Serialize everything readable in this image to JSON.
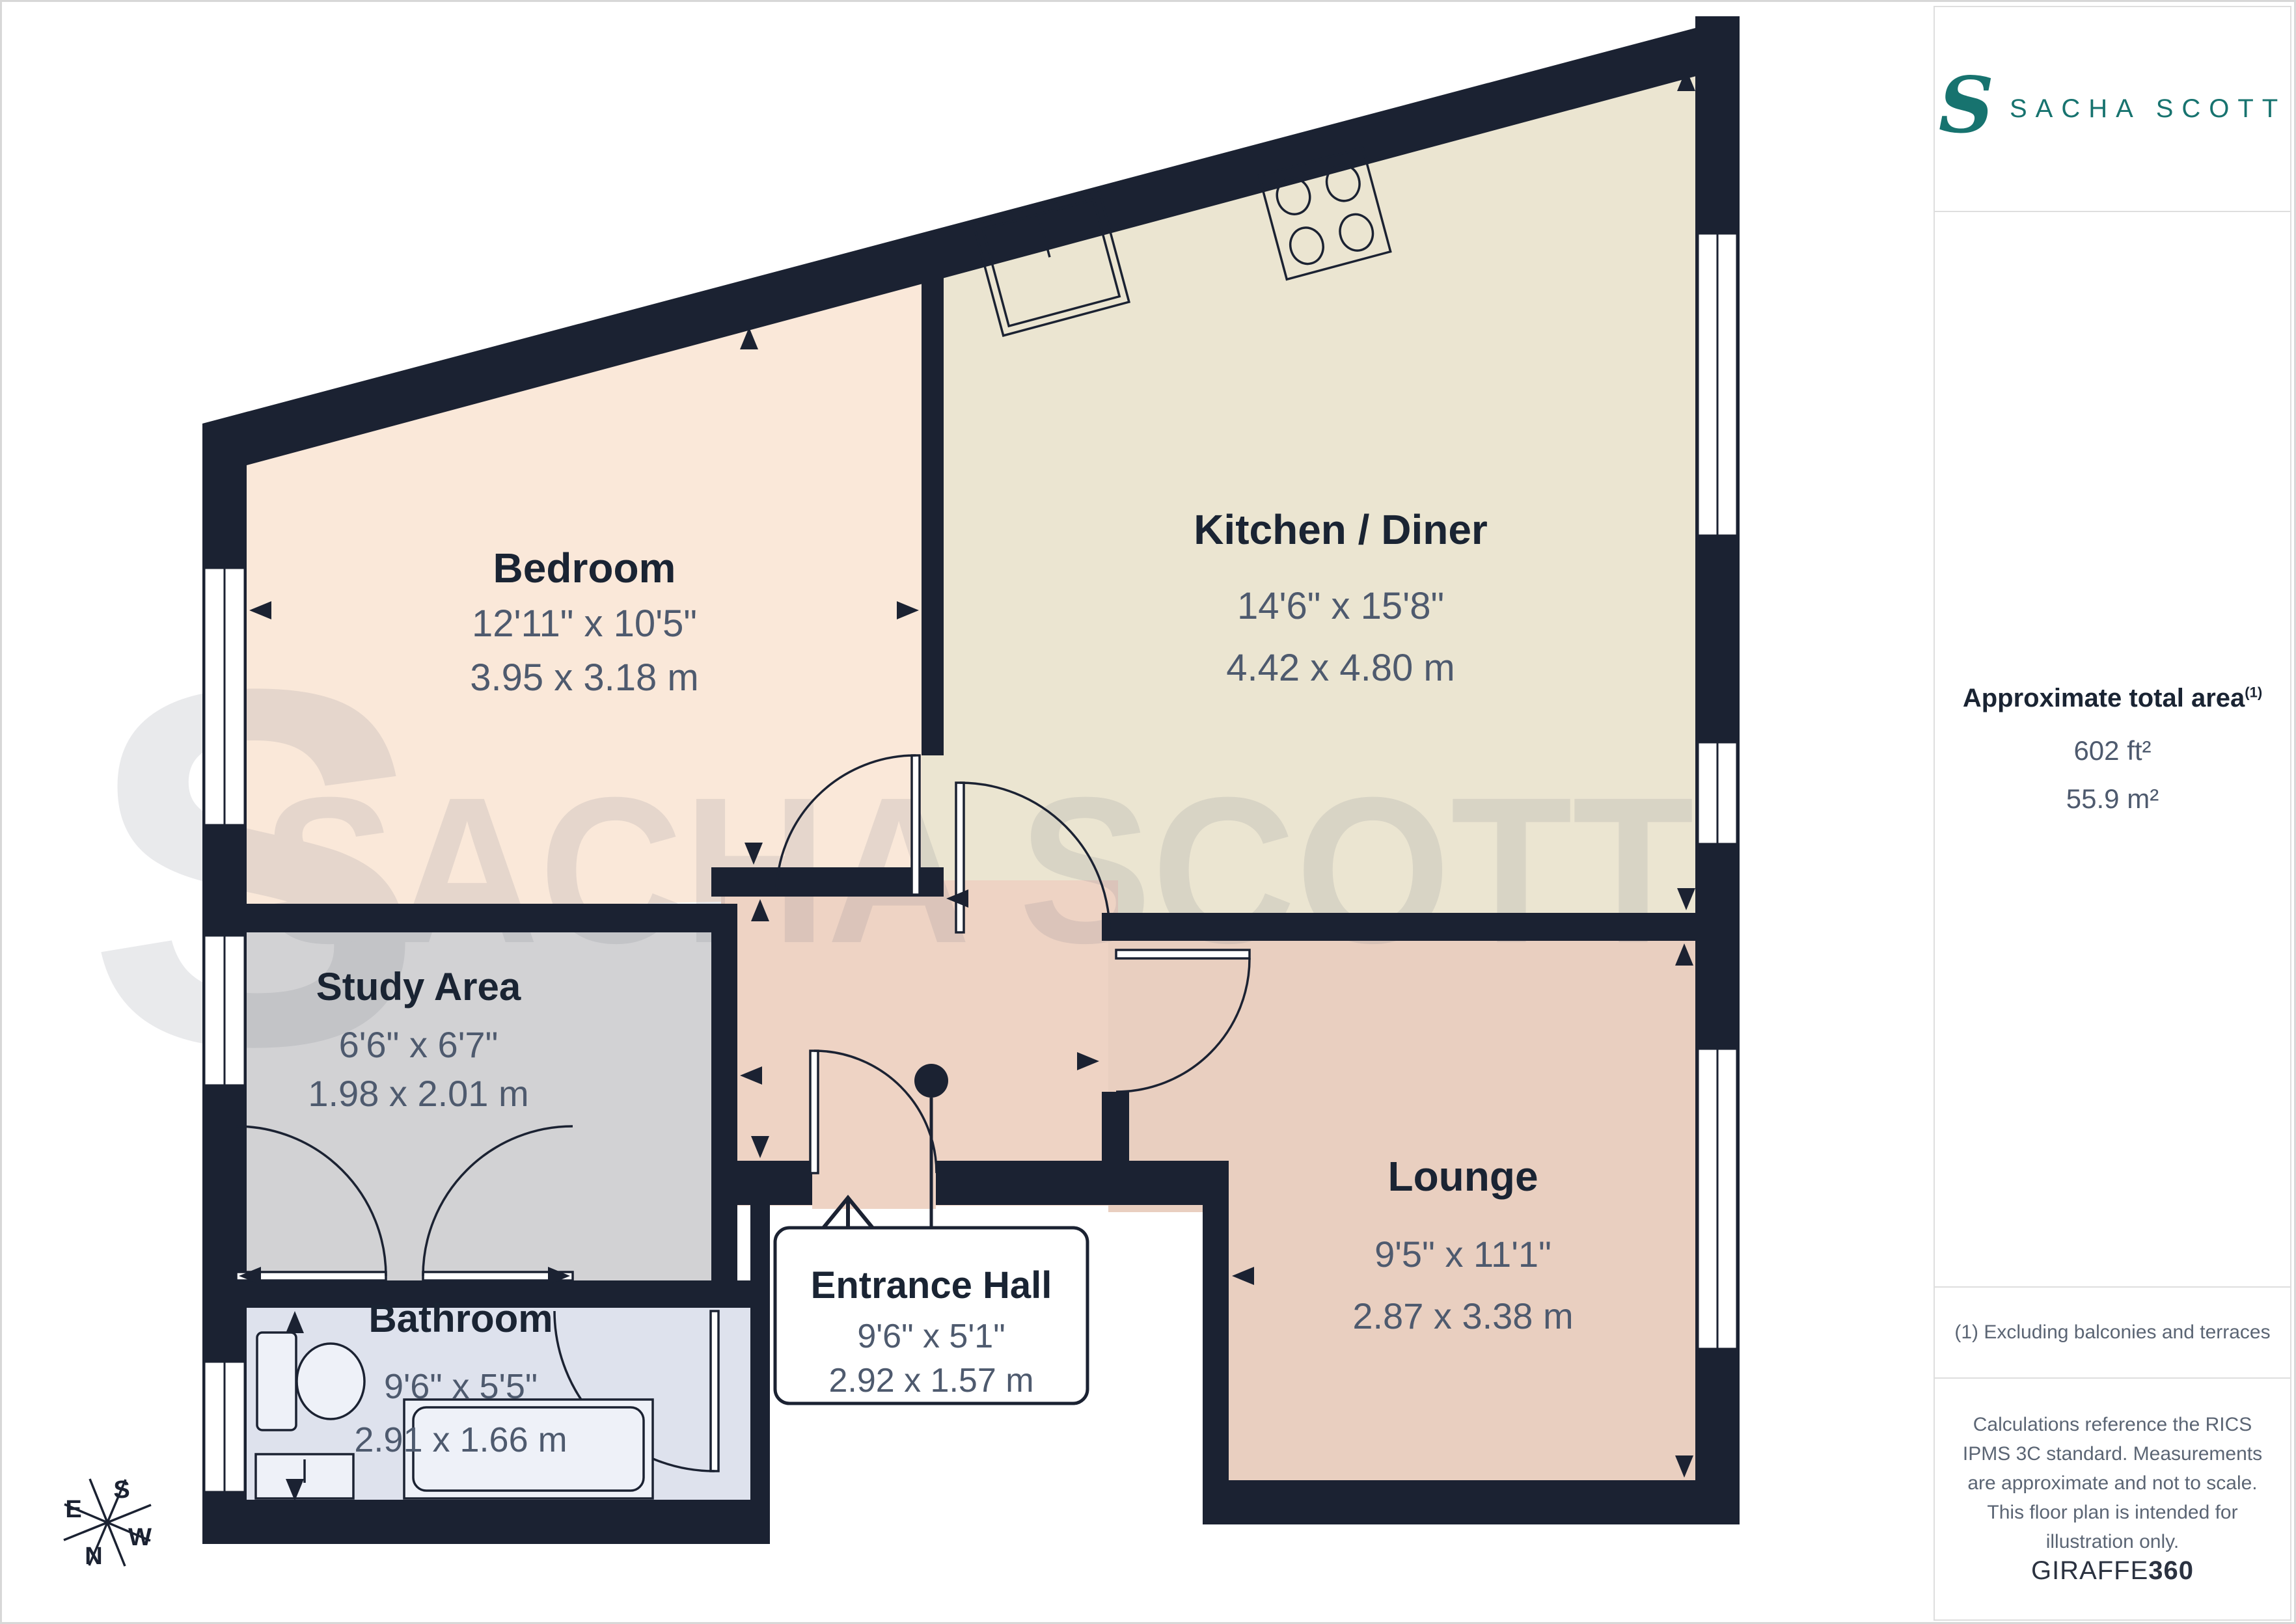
{
  "plan": {
    "rooms": {
      "bedroom": {
        "name": "Bedroom",
        "dims_imperial": "12'11\" x 10'5\"",
        "dims_metric": "3.95 x 3.18 m"
      },
      "kitchen": {
        "name": "Kitchen / Diner",
        "dims_imperial": "14'6\" x 15'8\"",
        "dims_metric": "4.42 x 4.80 m"
      },
      "study": {
        "name": "Study Area",
        "dims_imperial": "6'6\" x 6'7\"",
        "dims_metric": "1.98 x 2.01 m"
      },
      "lounge": {
        "name": "Lounge",
        "dims_imperial": "9'5\" x 11'1\"",
        "dims_metric": "2.87 x 3.38 m"
      },
      "entrance_hall": {
        "name": "Entrance Hall",
        "dims_imperial": "9'6\" x 5'1\"",
        "dims_metric": "2.92 x 1.57 m"
      },
      "bathroom": {
        "name": "Bathroom",
        "dims_imperial": "9'6\" x 5'5\"",
        "dims_metric": "2.91 x 1.66 m"
      }
    },
    "watermark": {
      "initial": "S",
      "text": "SACHA SCOTT"
    },
    "compass": {
      "n": "N",
      "e": "E",
      "s": "S",
      "w": "W"
    }
  },
  "sidebar": {
    "logo": {
      "initial": "S",
      "brand": "SACHA SCOTT",
      "color": "#17736f"
    },
    "area": {
      "title": "Approximate total area",
      "marker": "(1)",
      "imperial": "602 ft²",
      "metric": "55.9 m²"
    },
    "footnote": "(1) Excluding balconies and terraces",
    "disclaimer": "Calculations reference the RICS IPMS 3C standard. Measurements are approximate and not to scale. This floor plan is intended for illustration only.",
    "credit": {
      "brand": "GIRAFFE",
      "suffix": "360"
    }
  },
  "colors": {
    "wall": "#1b2232",
    "bedroom": "#fae8d9",
    "kitchen": "#ebe5d1",
    "study": "#d2d2d4",
    "hall": "#eed3c4",
    "lounge": "#e9cfc0",
    "bathroom": "#dee2ed",
    "brand_teal": "#17736f",
    "dims_text": "#4e5a6e"
  }
}
